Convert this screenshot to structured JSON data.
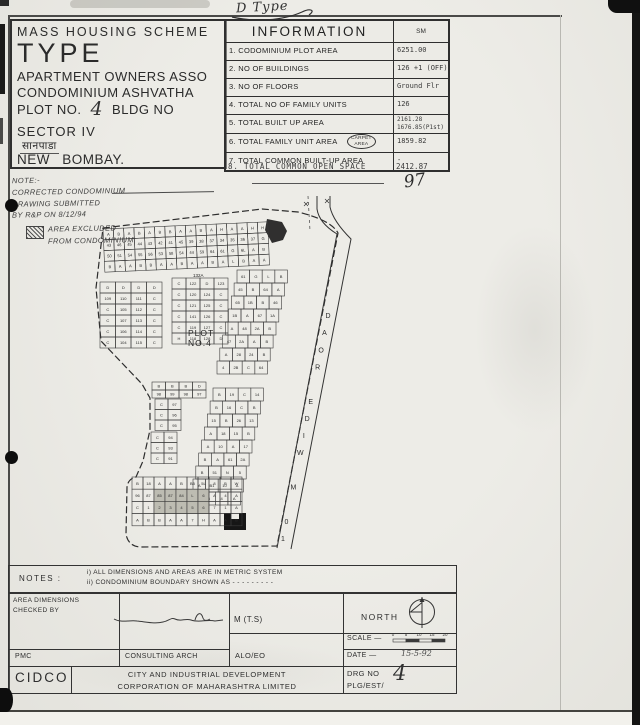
{
  "annotations": {
    "top_right_note": "D Type",
    "sheet_number": "97",
    "date_value": "15-5-92",
    "drg_no_value": "4",
    "plot_no_value": "4"
  },
  "scheme_box": {
    "line1": "MASS HOUSING SCHEME",
    "line2": "TYPE",
    "line3": "APARTMENT OWNERS ASSO",
    "line4": "CONDOMINIUM ASHVATHA",
    "plot_label": "PLOT NO.",
    "bldg_label": "BLDG NO",
    "line6": "SECTOR IV",
    "line7": "सानपाडा",
    "line8": "NEW BOMBAY."
  },
  "info_table": {
    "title": "INFORMATION",
    "unit": "SM",
    "rows": [
      {
        "label": "1. CODOMINIUM PLOT AREA",
        "value": "6251.00"
      },
      {
        "label": "2. NO OF BUILDINGS",
        "value": "126 +1 (OFF)"
      },
      {
        "label": "3. NO OF FLOORS",
        "value": "Ground Flr"
      },
      {
        "label": "4. TOTAL NO OF FAMILY UNITS",
        "value": "126"
      },
      {
        "label": "5. TOTAL BUILT UP AREA",
        "value": [
          "2161.28",
          "1676.85(P1st)"
        ]
      },
      {
        "label": "6. TOTAL FAMILY UNIT AREA",
        "bubble": [
          "CARPET",
          "AREA"
        ],
        "value": "1859.82"
      },
      {
        "label": "7. TOTAL COMMON BUILT-UP AREA",
        "value": "-"
      }
    ],
    "row8": {
      "label": "8. TOTAL COMMON OPEN SPACE",
      "value": "2412.87"
    }
  },
  "side_note": {
    "heading": "NOTE:-",
    "lines": [
      "CORRECTED CONDOMINIUM",
      "DRAWING SUBMITTED",
      "BY R&P ON 8/12/94"
    ],
    "legend": [
      "AREA EXCLUDED",
      "FROM CONDOMINIUM"
    ]
  },
  "site_plan": {
    "plot_label": [
      "PLOT",
      "NO.4"
    ],
    "road_label": "10 M WIDE ROAD",
    "block_label": "132A",
    "clusters": [
      {
        "name": "top-band",
        "x": 103,
        "y": 229,
        "cols": 16,
        "rows": 4,
        "cw": 10.3,
        "ch": 10.8,
        "rot": -2.5,
        "labels": [
          "A",
          "B",
          "A",
          "B",
          "A",
          "B",
          "B",
          "A",
          "A",
          "B",
          "A",
          "H",
          "A",
          "A",
          "H",
          "H",
          "43",
          "46",
          "45",
          "44",
          "43",
          "42",
          "41",
          "45",
          "39",
          "38",
          "37",
          "34",
          "35",
          "36",
          "37",
          "G",
          "50",
          "51",
          "54",
          "55",
          "56",
          "53",
          "58",
          "54",
          "44",
          "59",
          "64",
          "61",
          "G",
          "6L",
          "A",
          "B",
          "B",
          "A",
          "A",
          "B",
          "B",
          "A",
          "A",
          "B",
          "A",
          "A",
          "B",
          "A",
          "L",
          "B",
          "A",
          "A"
        ]
      },
      {
        "name": "block-d",
        "x": 100,
        "y": 282,
        "cols": 4,
        "rows": 6,
        "cw": 15.5,
        "ch": 11,
        "labels": [
          "D",
          "D",
          "D",
          "D",
          "109",
          "110",
          "111",
          "C",
          "C",
          "105",
          "112",
          "C",
          "C",
          "107",
          "113",
          "C",
          "C",
          "106",
          "114",
          "C",
          "C",
          "104",
          "115",
          "C"
        ]
      },
      {
        "name": "block-c",
        "x": 172,
        "y": 278,
        "cols": 4,
        "rows": 6,
        "cw": 14,
        "ch": 11,
        "labels": [
          "C",
          "122",
          "D",
          "123",
          "C",
          "120",
          "124",
          "C",
          "C",
          "121",
          "125",
          "C",
          "C",
          "141",
          "126",
          "C",
          "C",
          "119",
          "127",
          "C",
          "H",
          "118",
          "128",
          "D"
        ]
      },
      {
        "name": "road-strip-upper",
        "x": 237,
        "y": 270,
        "cols": 4,
        "rows": 8,
        "cw": 12.6,
        "ch": 13,
        "shear": -0.22,
        "labels": [
          "61",
          "G",
          "L",
          "B",
          "45",
          "B",
          "64",
          "A",
          "65",
          "1B",
          "B",
          "46",
          "1B",
          "A",
          "67",
          "1A",
          "A",
          "48",
          "2A",
          "B",
          "47",
          "2A",
          "A",
          "B",
          "A",
          "28",
          "24",
          "B",
          "4",
          "2B",
          "C",
          "64"
        ]
      },
      {
        "name": "road-strip-lower",
        "x": 213,
        "y": 388,
        "cols": 4,
        "rows": 9,
        "cw": 12.6,
        "ch": 13,
        "shear": -0.22,
        "labels": [
          "B",
          "19",
          "C",
          "14",
          "B",
          "16",
          "C",
          "B",
          "15",
          "B",
          "26",
          "13",
          "A",
          "18",
          "15",
          "B",
          "A",
          "10",
          "A",
          "17",
          "B",
          "A",
          "61",
          "2A",
          "B",
          "51",
          "N",
          "5",
          "A",
          "B1",
          "10",
          "A",
          "B",
          "6",
          "4",
          "A"
        ]
      },
      {
        "name": "mid-row",
        "x": 152,
        "y": 382,
        "cols": 4,
        "rows": 2,
        "cw": 13.5,
        "ch": 8,
        "labels": [
          "B",
          "B",
          "B",
          "D",
          "98",
          "99",
          "98",
          "97"
        ]
      },
      {
        "name": "left-strip",
        "x": 155,
        "y": 399,
        "cols": 2,
        "rows": 3,
        "cw": 13,
        "ch": 10.5,
        "labels": [
          "C",
          "97",
          "C",
          "96",
          "C",
          "95"
        ]
      },
      {
        "name": "left-strip-2",
        "x": 151,
        "y": 432,
        "cols": 2,
        "rows": 3,
        "cw": 13,
        "ch": 10.5,
        "labels": [
          "C",
          "94",
          "C",
          "93",
          "C",
          "91"
        ]
      },
      {
        "name": "bottom-block",
        "x": 132,
        "y": 477,
        "cols": 10,
        "rows": 4,
        "cw": 11,
        "ch": 12.2,
        "labels": [
          "B",
          "18",
          "A",
          "A",
          "B",
          "B5",
          "5L",
          "8",
          "B",
          "W",
          "96",
          "87",
          "85",
          "87",
          "84",
          "L",
          "6",
          "A",
          "4",
          "A",
          "C",
          "1",
          "2",
          "3",
          "4",
          "5",
          "6",
          "7",
          "1",
          "A",
          "A",
          "B",
          "B",
          "A",
          "A",
          "7",
          "H",
          "A",
          "A",
          "B"
        ],
        "shaded": [
          12,
          13,
          14,
          15,
          16,
          22,
          23,
          24,
          25,
          26
        ]
      }
    ]
  },
  "notes_box": {
    "label": "NOTES :",
    "line1": "i) ALL DIMENSIONS AND AREAS ARE IN METRIC SYSTEM",
    "line2": "ii) CONDOMINIUM BOUNDARY SHOWN AS  - - - - - - - - -"
  },
  "footer": {
    "checked_by": [
      "AREA DIMENSIONS",
      "CHECKED BY"
    ],
    "mts": "M (T.S)",
    "north_label": "NORTH",
    "pmc": "PMC",
    "consulting": "CONSULTING ARCH",
    "officer": "ALO/EO",
    "scale_label": "SCALE —",
    "scale_ticks": [
      "0",
      "5",
      "10",
      "15",
      "20"
    ],
    "date_label": "DATE —",
    "org_short": "CIDCO",
    "org_lines": [
      "CITY AND INDUSTRIAL DEVELOPMENT",
      "CORPORATION OF MAHARASHTRA LIMITED"
    ],
    "drg_label": [
      "DRG NO",
      "PLG/EST/"
    ]
  }
}
